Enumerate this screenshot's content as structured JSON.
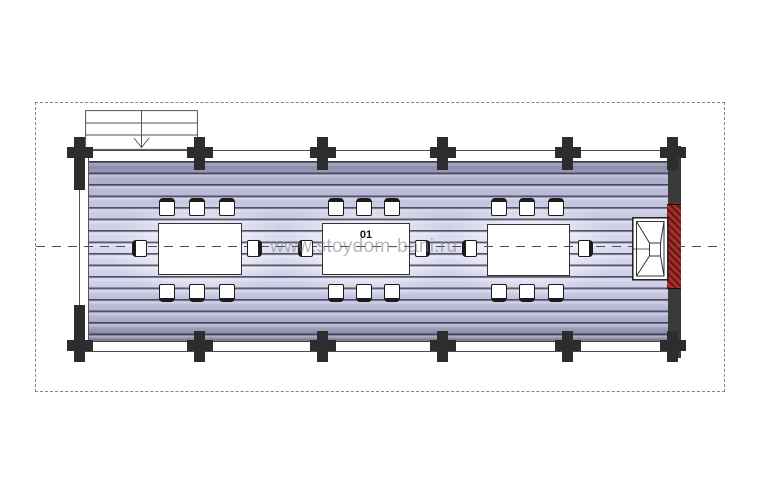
{
  "drawing": {
    "room_label": "01",
    "watermark": "www.stoydom-bani.ru",
    "tables_count": 3,
    "chairs_per_table": 8,
    "colors": {
      "floor_light": "#d7d7ef",
      "floor_shadow": "#73738f",
      "wall_dark": "#3a3a3a",
      "column": "#2d2d2d",
      "chimney_red": "#a03030",
      "boundary_dash": "#858585",
      "watermark_gray": "#7d7d8a"
    }
  }
}
